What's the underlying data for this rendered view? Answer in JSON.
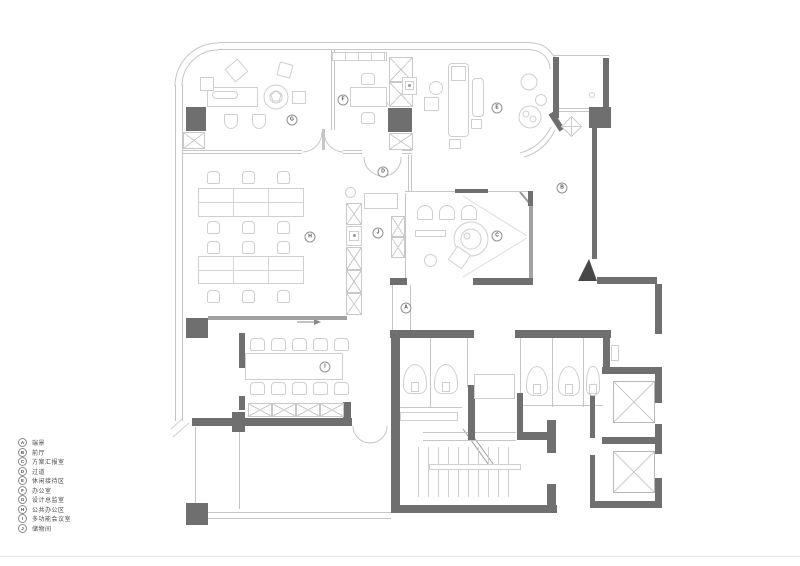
{
  "legend": {
    "items": [
      {
        "letter": "A",
        "label": "端景"
      },
      {
        "letter": "B",
        "label": "前厅"
      },
      {
        "letter": "C",
        "label": "方案汇报室"
      },
      {
        "letter": "D",
        "label": "过道"
      },
      {
        "letter": "E",
        "label": "休闲接待区"
      },
      {
        "letter": "F",
        "label": "办公室"
      },
      {
        "letter": "G",
        "label": "设计总监室"
      },
      {
        "letter": "H",
        "label": "公共办公区"
      },
      {
        "letter": "I",
        "label": "多功能会议室"
      },
      {
        "letter": "J",
        "label": "储物间"
      }
    ]
  },
  "colors": {
    "structural_wall": "#6f6f6f",
    "partition_line": "#c6c6c6",
    "furniture_line": "#cfcfcf",
    "text": "#4a4a4a"
  }
}
